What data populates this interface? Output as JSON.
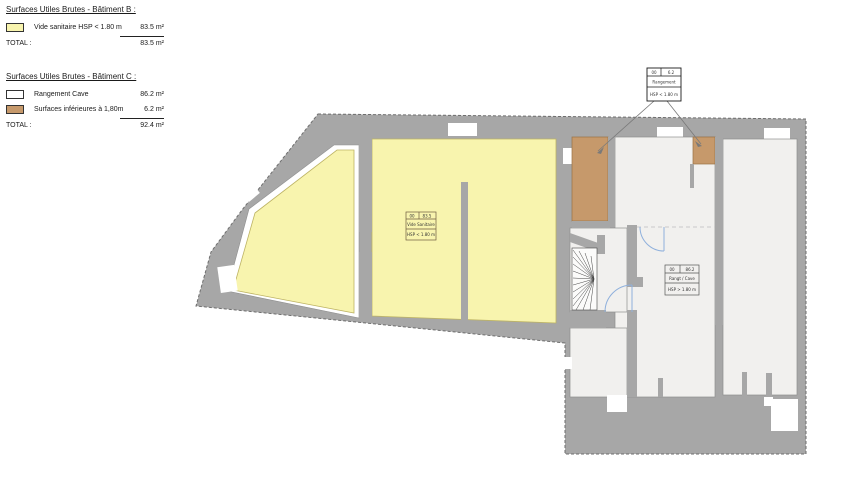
{
  "legends": [
    {
      "title": "Surfaces Utiles Brutes - Bâtiment B :",
      "rows": [
        {
          "swatch": "yellow",
          "label": "Vide sanitaire HSP < 1.80 m",
          "value": "83.5 m²"
        }
      ],
      "total_label": "TOTAL :",
      "total_value": "83.5 m²"
    },
    {
      "title": "Surfaces Utiles Brutes - Bâtiment C :",
      "rows": [
        {
          "swatch": "white",
          "label": "Rangement Cave",
          "value": "86.2 m²"
        },
        {
          "swatch": "brown",
          "label": "Surfaces inférieures à 1,80m",
          "value": "6.2 m²"
        }
      ],
      "total_label": "TOTAL :",
      "total_value": "92.4 m²"
    }
  ],
  "plan_labels": {
    "vide_sanitaire": {
      "num": "00",
      "area": "83.5",
      "name": "Vide Sanitaire",
      "note": "HSP < 1.80 m"
    },
    "surfaces_basses": {
      "num": "00",
      "area": "6.2",
      "name": "Rangement",
      "note": "HSP < 1.80 m"
    },
    "rangement_cave": {
      "num": "00",
      "area": "86.2",
      "name": "Rangt / Cave",
      "note": "HSP > 1.80 m"
    }
  },
  "colors": {
    "wall_gray": "#a7a7a7",
    "room_fill": "#f1f0ee",
    "vide_sanitaire_yellow": "#f8f4ae",
    "low_height_brown": "#c6996b",
    "door_swing_blue": "#8fb0dc",
    "outline_dash": "#6e6e6e"
  }
}
